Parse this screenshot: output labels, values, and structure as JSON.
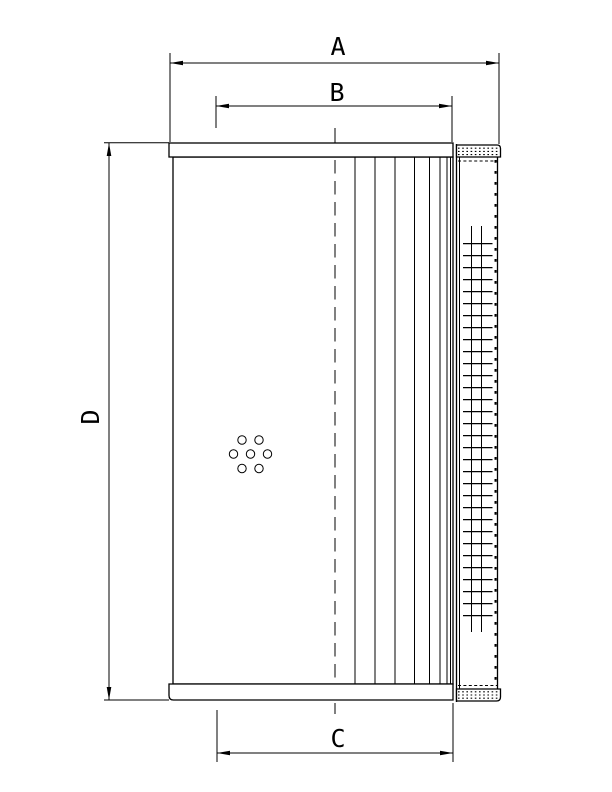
{
  "drawing": {
    "type_note": "technical dimension drawing of a cylindrical filter element",
    "dimension_labels": {
      "a": "A",
      "b": "B",
      "c": "C",
      "d": "D"
    },
    "colors": {
      "line_color": "#000000",
      "background_color": "#ffffff"
    }
  }
}
